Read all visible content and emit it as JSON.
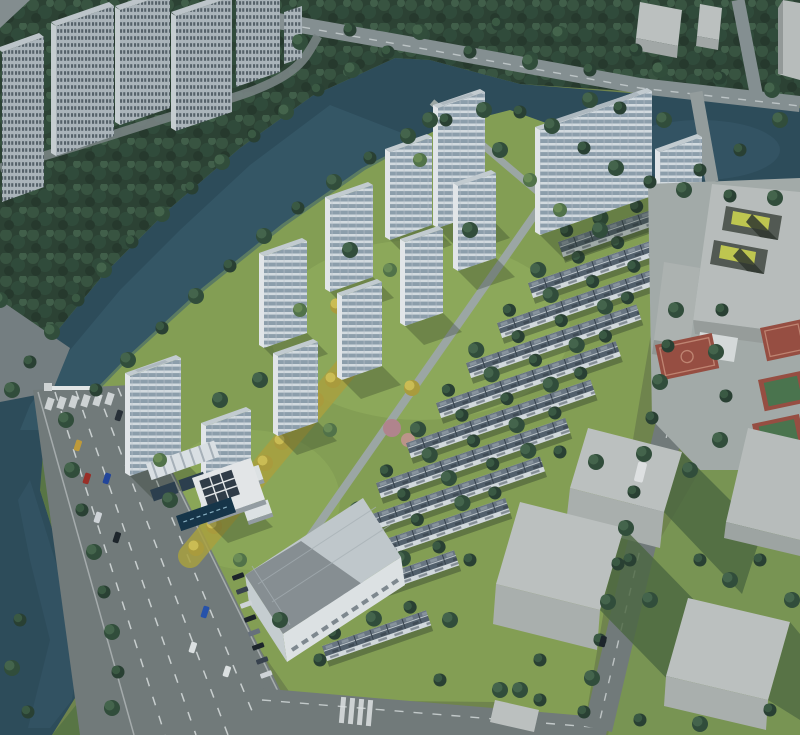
{
  "meta": {
    "type": "architectural-aerial-render",
    "subject": "Bird's-eye architectural rendering of a riverside residential master plan with white high-rise towers, rows of low-rise townhouses, a landscaped yellow-green axis, surrounding context buildings, a school block with courtyards, sports courts, a canal and multi-lane roads",
    "width": 800,
    "height": 735,
    "visible_text": "none"
  },
  "scene": {
    "regions": [
      {
        "name": "context-towers-top-left",
        "desc": "existing gray high-rise apartment slabs in dark tree mass"
      },
      {
        "name": "canal",
        "desc": "dark teal river winding from top-center to lower-left, widening into a pond at top-right"
      },
      {
        "name": "development-towers",
        "desc": "12 bright white residential towers with horizontal glass banding"
      },
      {
        "name": "townhouse-rows",
        "desc": "11 diagonal rows of low-rise units with slate roofs and white walls"
      },
      {
        "name": "landscape-axis",
        "desc": "yellow-foliage central garden band"
      },
      {
        "name": "school-block",
        "desc": "gray courtyard building with two sunken yellow courtyards"
      },
      {
        "name": "sports-courts",
        "desc": "red basketball court and red/green courts along right edge"
      },
      {
        "name": "massing-blocks-bottom-right",
        "desc": "plain gray context volumes with long shadows on lawn"
      },
      {
        "name": "commercial-building",
        "desc": "large white retail block with big gray roof at bottom-center"
      },
      {
        "name": "clubhouse",
        "desc": "white pavilion with dark skylights, lap pool and striped entry canopy"
      },
      {
        "name": "main-road",
        "desc": "wide multi-lane avenue lower-left with dashed lanes, cars, crosswalk and gate"
      },
      {
        "name": "perimeter-roads",
        "desc": "top road crossing the canal, right-side road, bottom road with crosswalk"
      }
    ],
    "counts": {
      "development_towers": 12,
      "townhouse_rows": 11,
      "context_towers_top_left": 6,
      "context_blocks_bottom_right": 5,
      "courtyards_in_school": 2
    },
    "palette": {
      "forest_dark": "#2e4434",
      "site_lawn": "#8aa556",
      "lawn_context": "#7e9a55",
      "water": "#2f4e5c",
      "road": "#767f7e",
      "road_top": "#8b9596",
      "plaza": "#aab1ae",
      "tower_white": "#edf0f2",
      "tower_glass_band": "#93a5b2",
      "tower_roof": "#ccd4d9",
      "townhouse_roof": "#56646f",
      "townhouse_wall": "#dce2e5",
      "context_block": "#c5c9c7",
      "court_red": "#9e5143",
      "court_green": "#4d7950",
      "foliage_yellow": "#d3c357",
      "pool": "#17364a"
    }
  }
}
